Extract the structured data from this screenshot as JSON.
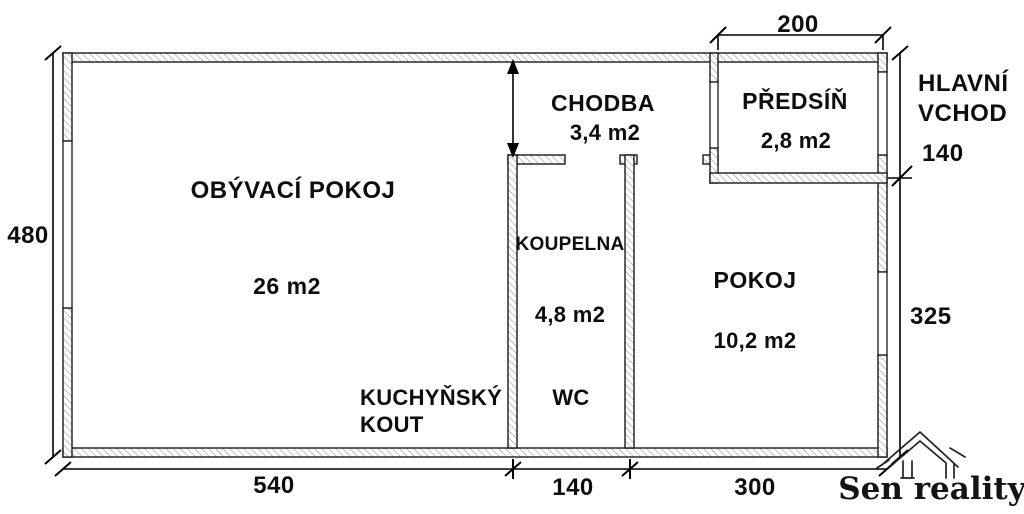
{
  "colors": {
    "background": "#ffffff",
    "wall_line": "#1a1a1a",
    "hatch": "#8a8a8a",
    "text": "#0d0d0d"
  },
  "rooms": {
    "living": {
      "label": "OBÝVACÍ POKOJ",
      "area": "26 m2"
    },
    "kitchenette": {
      "label_line1": "KUCHYŇSKÝ",
      "label_line2": "KOUT"
    },
    "hallway": {
      "label": "CHODBA",
      "area": "3,4 m2"
    },
    "vestibule": {
      "label": "PŘEDSÍŇ",
      "area": "2,8 m2"
    },
    "bathroom": {
      "label": "KOUPELNA",
      "area": "4,8 m2",
      "wc_label": "WC"
    },
    "room": {
      "label": "POKOJ",
      "area": "10,2 m2"
    }
  },
  "dimensions": {
    "left_height": "480",
    "bottom_living": "540",
    "bottom_bathroom": "140",
    "bottom_room": "300",
    "top_vestibule": "200",
    "right_entrance": "140",
    "right_room": "325"
  },
  "entrance": {
    "label_line1": "HLAVNÍ",
    "label_line2": "VCHOD"
  },
  "branding": {
    "agency": "Sen reality"
  }
}
